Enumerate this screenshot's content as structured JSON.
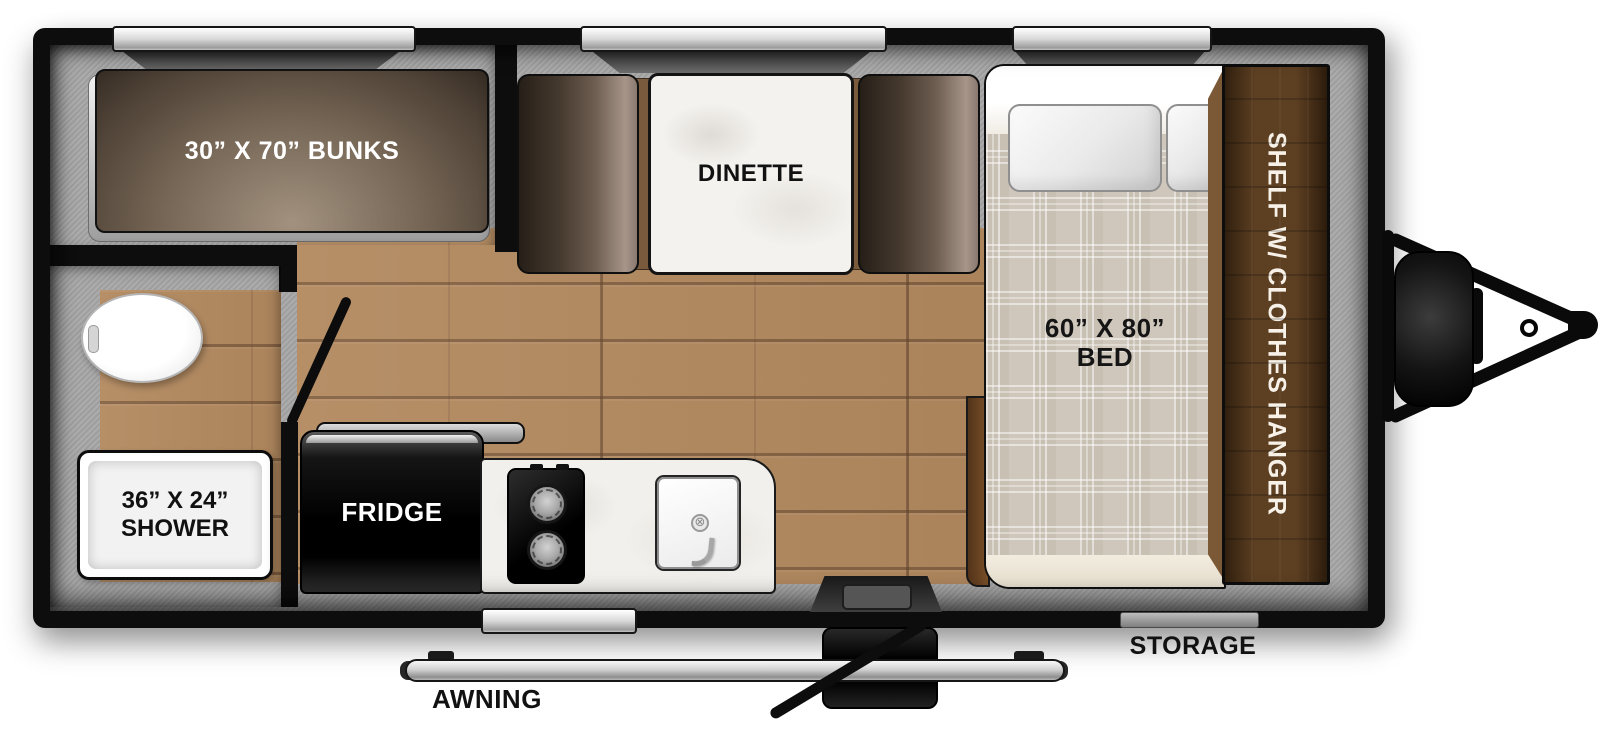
{
  "title": "Travel trailer floor plan",
  "areas": {
    "bunks": {
      "label": "30” X 70” BUNKS"
    },
    "dinette": {
      "label": "DINETTE"
    },
    "bed": {
      "size": "60” X 80”",
      "name": "BED"
    },
    "shelf": {
      "label": "SHELF W/ CLOTHES HANGER"
    },
    "shower": {
      "size": "36” X 24”",
      "name": "SHOWER"
    },
    "fridge": {
      "label": "FRIDGE"
    }
  },
  "exterior": {
    "awning_label": "AWNING",
    "storage_label": "STORAGE"
  },
  "fixtures": [
    "toilet",
    "shower",
    "fridge",
    "two-burner-stove",
    "sink",
    "entry-step",
    "propane-tank",
    "hitch",
    "awning-rail"
  ],
  "windows_count": 4,
  "colors": {
    "wall_black": "#0d0d0d",
    "floor_wood": "#b2895f",
    "interior_gray": "#a7a7a7",
    "furniture_brown": "#6f5e52",
    "shelf_brown": "#5d3f22",
    "mattress_plaid": "#cfc7bb",
    "window_silver": "#d8d8d8",
    "label_light": "#ffffff",
    "label_dark": "#111111"
  }
}
